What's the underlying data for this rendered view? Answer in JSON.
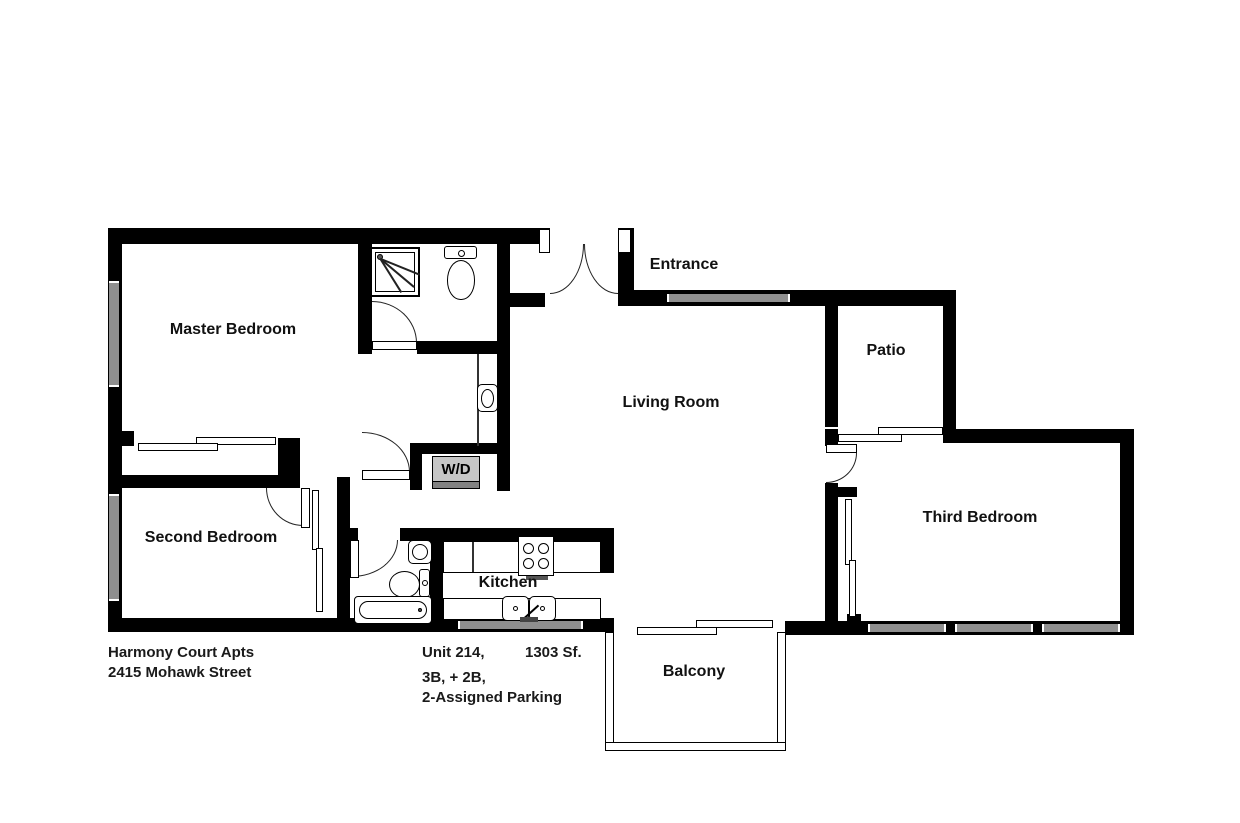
{
  "plan": {
    "rooms": {
      "master_bedroom": "Master Bedroom",
      "second_bedroom": "Second Bedroom",
      "third_bedroom": "Third Bedroom",
      "living_room": "Living Room",
      "kitchen": "Kitchen",
      "patio": "Patio",
      "balcony": "Balcony",
      "entrance": "Entrance",
      "washer_dryer": "W/D"
    }
  },
  "footer": {
    "building": "Harmony Court Apts",
    "address": "2415 Mohawk Street",
    "unit": "Unit 214,",
    "area": "1303 Sf.",
    "beds_baths": "3B, + 2B,",
    "parking": "2-Assigned Parking"
  },
  "colors": {
    "wall": "#000000",
    "window": "#8f8f8f",
    "appliance_fill": "#c6c6c6",
    "appliance_shadow": "#828282"
  }
}
